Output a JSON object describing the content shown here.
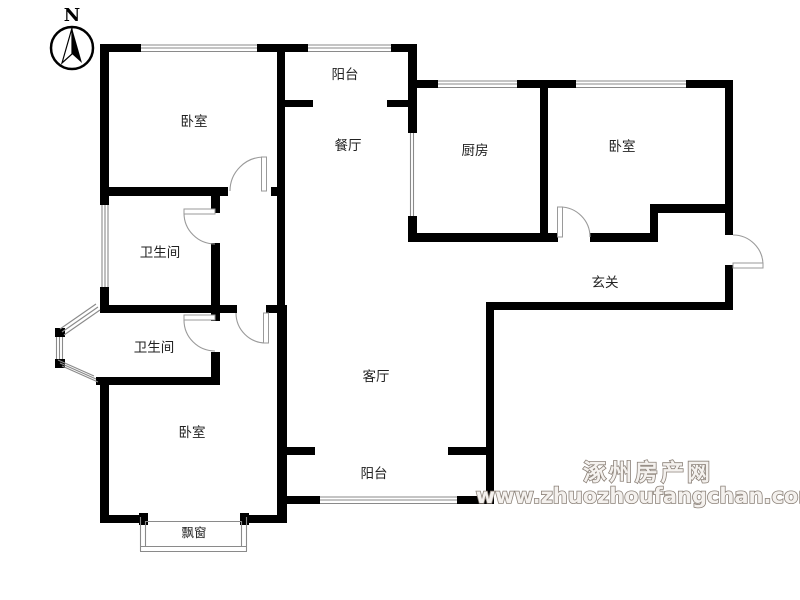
{
  "compass": {
    "label": "N"
  },
  "rooms": [
    {
      "id": "bedroom-topleft",
      "label": "卧室"
    },
    {
      "id": "balcony-top",
      "label": "阳台"
    },
    {
      "id": "dining",
      "label": "餐厅"
    },
    {
      "id": "kitchen",
      "label": "厨房"
    },
    {
      "id": "bedroom-topright",
      "label": "卧室"
    },
    {
      "id": "bathroom-upper",
      "label": "卫生间"
    },
    {
      "id": "entry-hall",
      "label": "玄关"
    },
    {
      "id": "bathroom-lower",
      "label": "卫生间"
    },
    {
      "id": "living-room",
      "label": "客厅"
    },
    {
      "id": "bedroom-bottom",
      "label": "卧室"
    },
    {
      "id": "balcony-bottom",
      "label": "阳台"
    },
    {
      "id": "bay-window",
      "label": "飘窗"
    }
  ],
  "watermark": {
    "title": "涿州房产网",
    "url": "www.zhuozhoufangchan.com",
    "color": "#8b8178"
  },
  "colors": {
    "wall": "#000000",
    "window_line": "#8a8a8a",
    "door_arc": "#9a9a9a",
    "label_text": "#222222"
  }
}
